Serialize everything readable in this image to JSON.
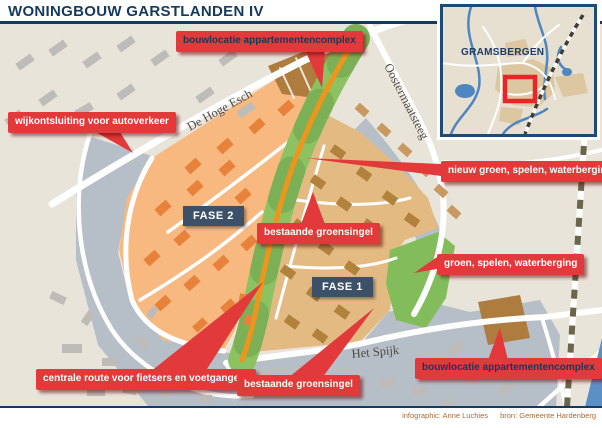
{
  "title": "WONINGBOUW GARSTLANDEN IV",
  "inset": {
    "title": "GRAMSBERGEN"
  },
  "streets": [
    {
      "name": "De Hoge Esch"
    },
    {
      "name": "Oostermaatsteeg"
    },
    {
      "name": "Het Spijk"
    }
  ],
  "phases": [
    {
      "label": "FASE 2"
    },
    {
      "label": "FASE 1"
    }
  ],
  "callouts": [
    {
      "label": "bouwlocatie appartementencomplex"
    },
    {
      "label": "wijkontsluiting voor autoverkeer"
    },
    {
      "label": "nieuw groen, spelen, waterberging"
    },
    {
      "label": "bestaande groensingel"
    },
    {
      "label": "groen, spelen, waterberging"
    },
    {
      "label": "centrale route voor fietsers en voetgangers"
    },
    {
      "label": "bestaande groensingel"
    },
    {
      "label": "bouwlocatie appartementencomplex"
    }
  ],
  "credits": {
    "left": "infographic: Anne Luchies",
    "right": "bron: Gemeente Hardenberg"
  },
  "colors": {
    "accent_red": "#e23a3b",
    "navy": "#16395f",
    "green_singel": "#8cc262",
    "route_orange": "#f0951c",
    "phase2_orange": "#f7b97f",
    "phase1_tan": "#e3bb82",
    "apartments_brown": "#ad7c3e",
    "existing_gray_blue": "#b6bec7",
    "water_blue": "#5d8fc7"
  }
}
